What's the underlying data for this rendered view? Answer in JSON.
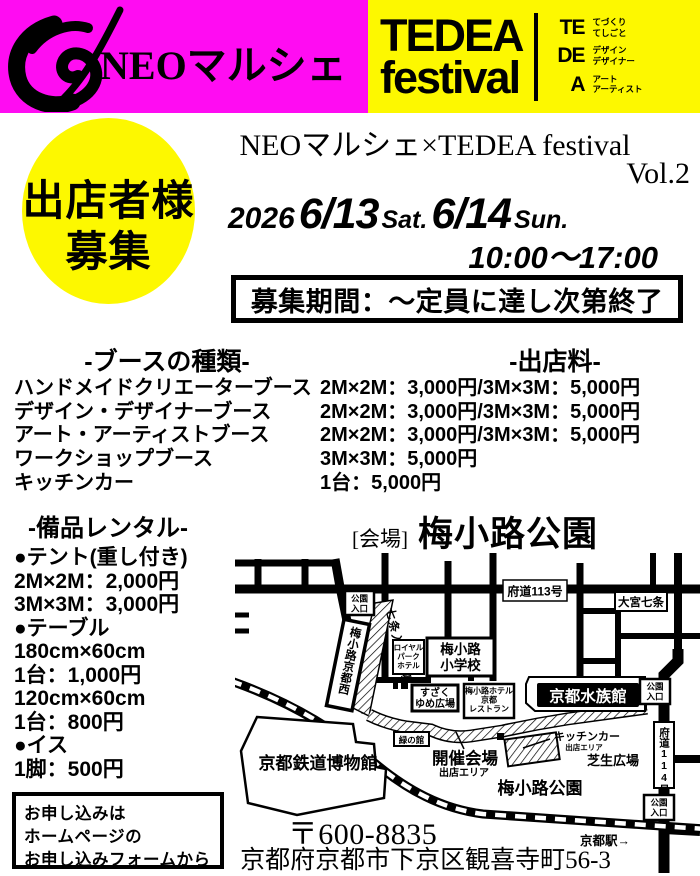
{
  "colors": {
    "magenta": "#ff0cf2",
    "yellow": "#fdf800",
    "black": "#000000"
  },
  "header": {
    "brand": "NEOマルシェ",
    "logo_title": "TEDEA",
    "logo_subtitle": "festival",
    "acronym": [
      {
        "abbr": "TE",
        "line1": "てづくり",
        "line2": "てしごと"
      },
      {
        "abbr": "DE",
        "line1": "デザイン",
        "line2": "デザイナー"
      },
      {
        "abbr": "A",
        "line1": "アート",
        "line2": "アーティスト"
      }
    ]
  },
  "hero": {
    "badge_line1": "出店者様",
    "badge_line2": "募集",
    "title": "NEOマルシェ×TEDEA festival",
    "title_vol": "Vol.2",
    "year": "2026",
    "day1": "6/13",
    "day1_suffix": "Sat.",
    "day2": "6/14",
    "day2_suffix": "Sun.",
    "time": "10:00～17:00",
    "recruit_period": "募集期間：～定員に達し次第終了"
  },
  "booths": {
    "header_left": "-ブースの種類-",
    "header_right": "-出店料-",
    "rows": [
      {
        "type": "ハンドメイドクリエーターブース",
        "fee": "2M×2M：3,000円/3M×3M：5,000円"
      },
      {
        "type": "デザイン・デザイナーブース",
        "fee": "2M×2M：3,000円/3M×3M：5,000円"
      },
      {
        "type": "アート・アーティストブース",
        "fee": "2M×2M：3,000円/3M×3M：5,000円"
      },
      {
        "type": "ワークショップブース",
        "fee": "3M×3M：5,000円"
      },
      {
        "type": "キッチンカー",
        "fee": "1台：5,000円"
      }
    ]
  },
  "rental": {
    "header": "-備品レンタル-",
    "lines": [
      "●テント(重し付き)",
      "2M×2M：2,000円",
      "3M×3M：3,000円",
      "●テーブル",
      "180cm×60cm",
      "1台：1,000円",
      "120cm×60cm",
      "1台：800円",
      "●イス",
      "1脚：500円"
    ]
  },
  "venue": {
    "bracket": "[会場]",
    "name": "梅小路公園",
    "postal": "〒600-8835",
    "address": "京都府京都市下京区観喜寺町56-3"
  },
  "apply": {
    "line1": "お申し込みは",
    "line2": "ホームページの",
    "line3": "お申し込みフォームから"
  },
  "map": {
    "labels": {
      "park_entrance_top": "公園",
      "park_entrance_bottom": "入口",
      "route113": "府道113号",
      "omiya_shichijo": "大宮七条",
      "shichijo_entrance_plaza": "七条入口広場",
      "umekoji_kyotonishi_station": "梅小路京都西",
      "royal1": "ロイヤル",
      "royal2": "パーク",
      "royal3": "ホテル",
      "school1": "梅小路",
      "school2": "小学校",
      "suzaku1": "すざく",
      "suzaku2": "ゆめ広場",
      "hotel1": "梅小路ホテル",
      "hotel2": "京都",
      "hotel3": "レストラン",
      "aquarium": "京都水族館",
      "green_house": "緑の館",
      "event1": "開催会場",
      "event2": "出店エリア",
      "kitchen1": "キッチンカー",
      "kitchen2": "出店エリア",
      "lawn": "芝生広場",
      "route114": "府道114号",
      "museum": "京都鉄道博物館",
      "park": "梅小路公園",
      "station": "京都駅→"
    }
  }
}
